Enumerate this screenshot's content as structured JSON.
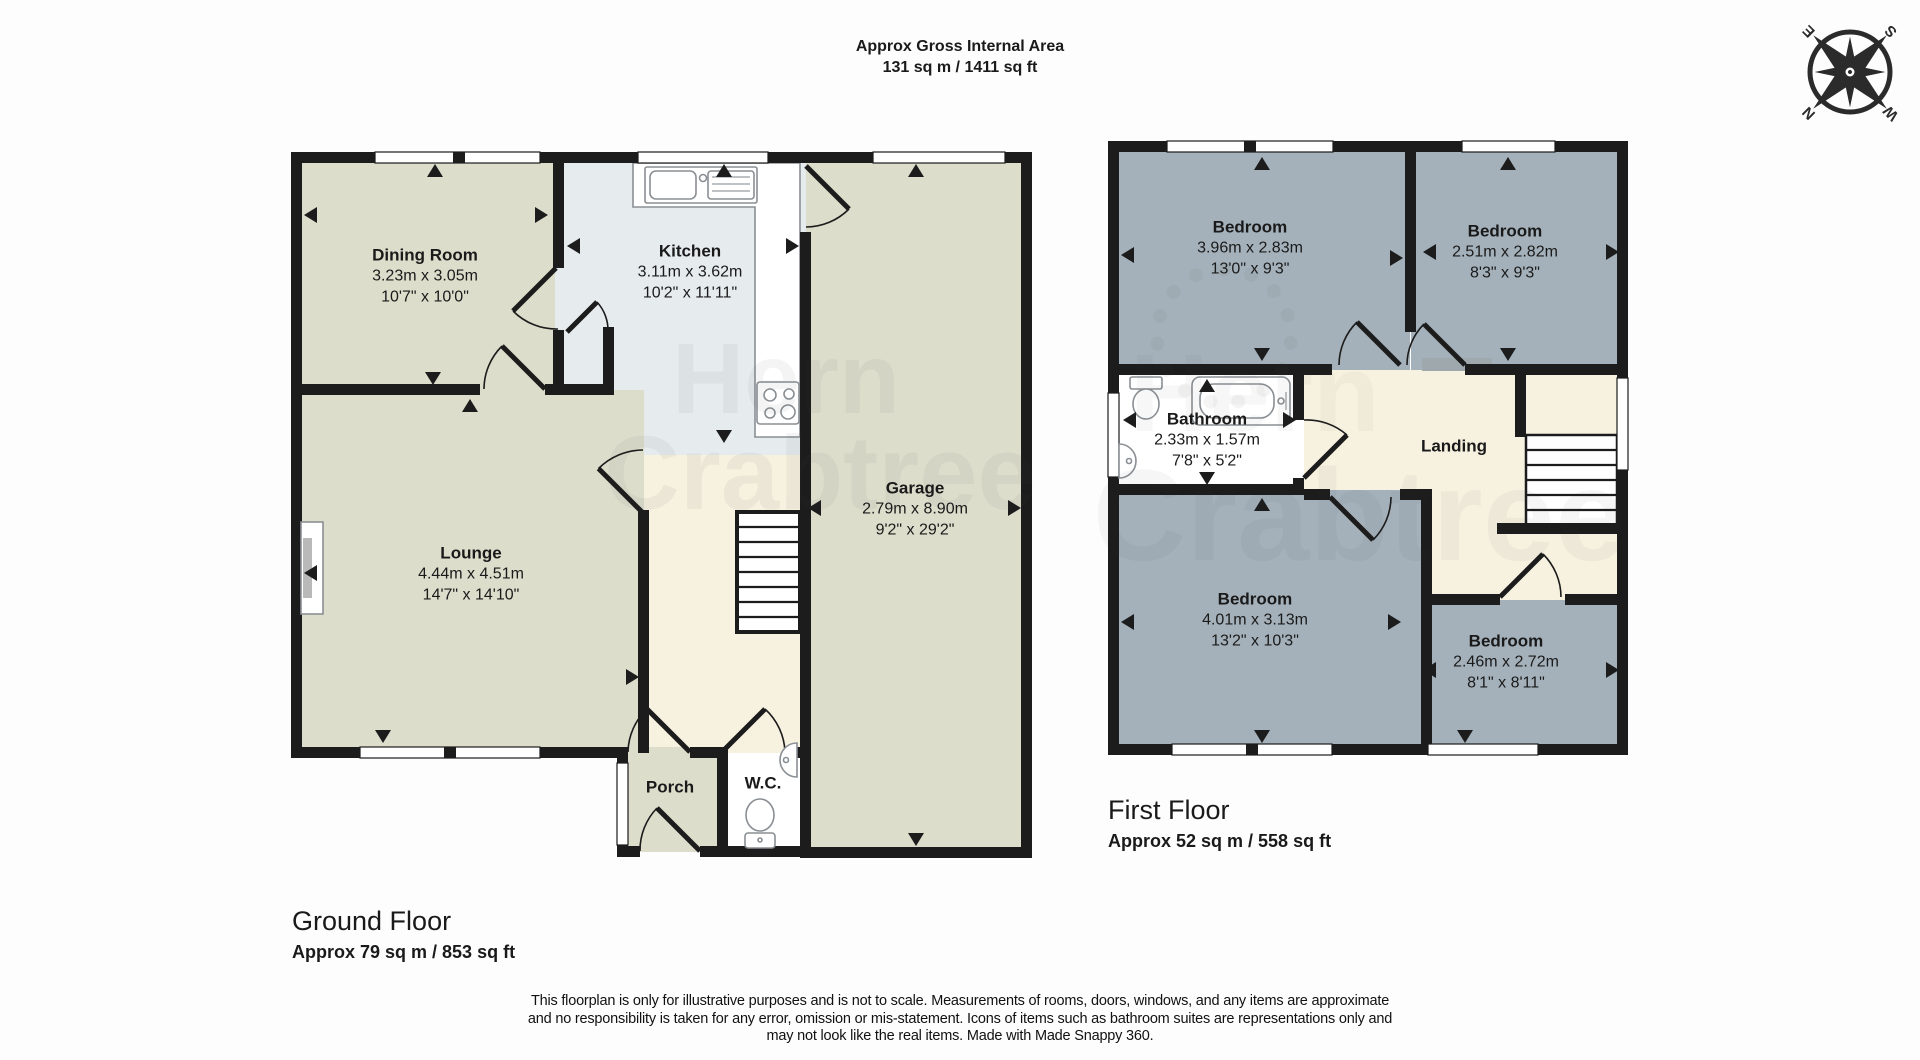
{
  "header": {
    "title_line1": "Approx Gross Internal Area",
    "title_line2": "131 sq m / 1411 sq ft"
  },
  "compass": {
    "n": "N",
    "e": "E",
    "s": "S",
    "w": "W"
  },
  "watermark": {
    "line1": "Hern",
    "line2": "Crabtree"
  },
  "ground_floor": {
    "title": "Ground Floor",
    "area": "Approx 79 sq m / 853 sq ft",
    "rooms": [
      {
        "name": "Dining Room",
        "metric": "3.23m x 3.05m",
        "imperial": "10'7\" x 10'0\""
      },
      {
        "name": "Kitchen",
        "metric": "3.11m x 3.62m",
        "imperial": "10'2\" x 11'11\""
      },
      {
        "name": "Lounge",
        "metric": "4.44m x 4.51m",
        "imperial": "14'7\" x 14'10\""
      },
      {
        "name": "Garage",
        "metric": "2.79m x 8.90m",
        "imperial": "9'2\" x 29'2\""
      },
      {
        "name": "Porch"
      },
      {
        "name": "W.C."
      }
    ]
  },
  "first_floor": {
    "title": "First Floor",
    "area": "Approx 52 sq m / 558 sq ft",
    "rooms": [
      {
        "name": "Bedroom",
        "metric": "3.96m x 2.83m",
        "imperial": "13'0\" x 9'3\""
      },
      {
        "name": "Bedroom",
        "metric": "2.51m x 2.82m",
        "imperial": "8'3\" x 9'3\""
      },
      {
        "name": "Bathroom",
        "metric": "2.33m x 1.57m",
        "imperial": "7'8\" x 5'2\""
      },
      {
        "name": "Landing"
      },
      {
        "name": "Bedroom",
        "metric": "4.01m x 3.13m",
        "imperial": "13'2\" x 10'3\""
      },
      {
        "name": "Bedroom",
        "metric": "2.46m x 2.72m",
        "imperial": "8'1\" x 8'11\""
      }
    ]
  },
  "disclaimer": {
    "line1": "This floorplan is only for illustrative purposes and is not to scale. Measurements of rooms, doors, windows, and any items are approximate",
    "line2": "and no responsibility is taken for any error, omission or mis-statement. Icons of items such as bathroom suites are representations only and",
    "line3": "may not look like the real items. Made with Made Snappy 360."
  },
  "colors": {
    "room_beige": "#dcddcb",
    "kitchen_blue": "#e6ebee",
    "hall_cream": "#f7f1e0",
    "bedroom_blue": "#a4b1ba",
    "wall_black": "#1c1c1c",
    "stairs_gray": "#9fa9ad"
  }
}
